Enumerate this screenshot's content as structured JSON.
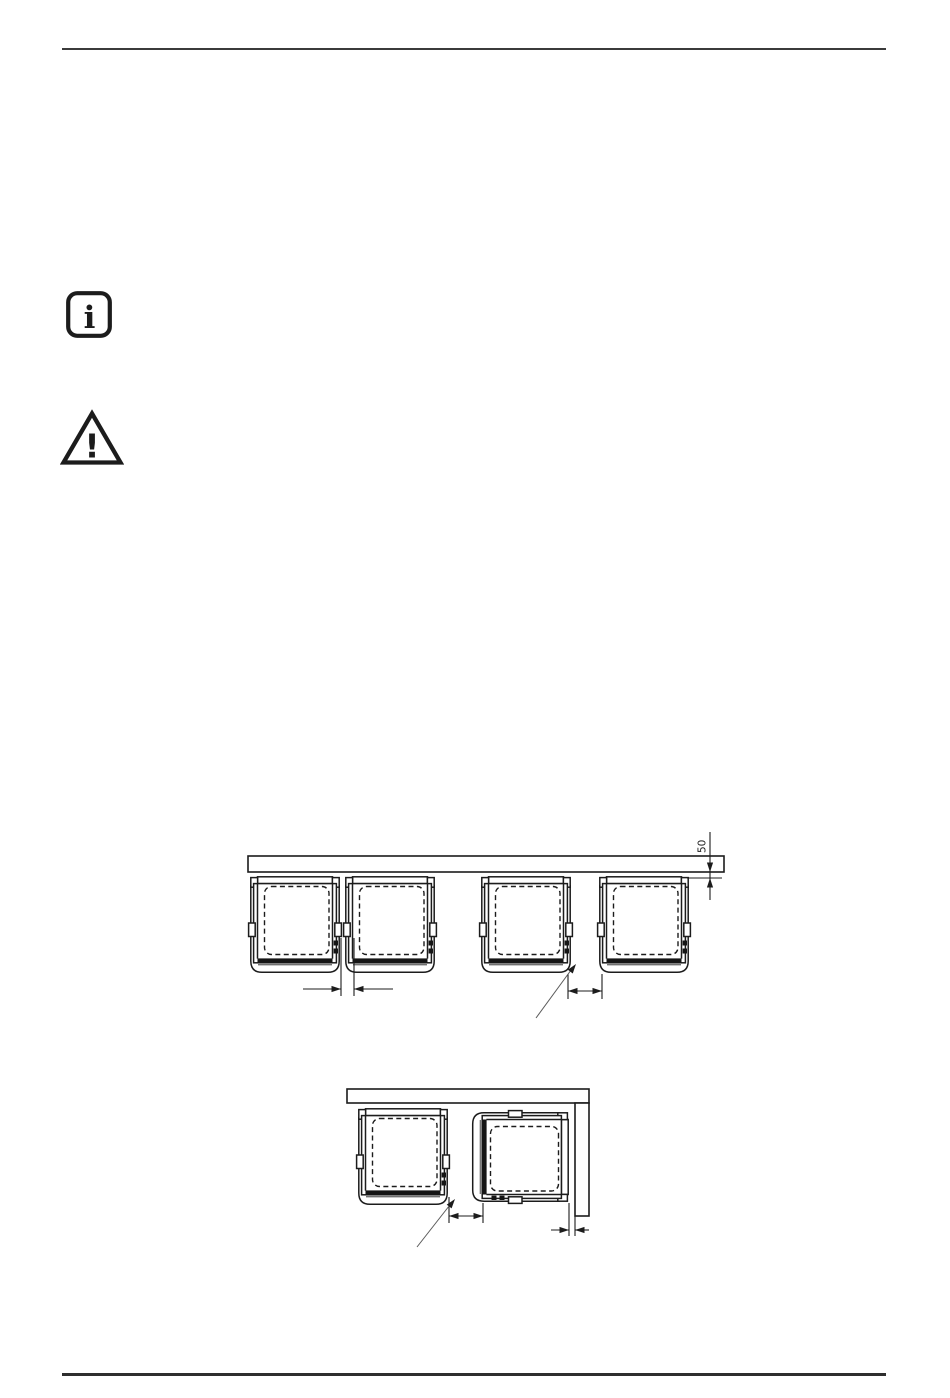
{
  "colors": {
    "paper": "#ffffff",
    "ink": "#1c1c1c",
    "hatch": "#4f4f4f",
    "rule": "#3b3b3b",
    "leader": "#5a5a5a",
    "fill": "#151515"
  },
  "icons": {
    "info_glyph": "i",
    "warning_glyph": "!"
  },
  "figure1": {
    "type": "technical-drawing",
    "description_role": "top view, four built-in units in a row against a wall",
    "wall_distance_label": "50"
  },
  "figure2": {
    "type": "technical-drawing",
    "description_role": "top view, two built-in units in a corner installation"
  }
}
